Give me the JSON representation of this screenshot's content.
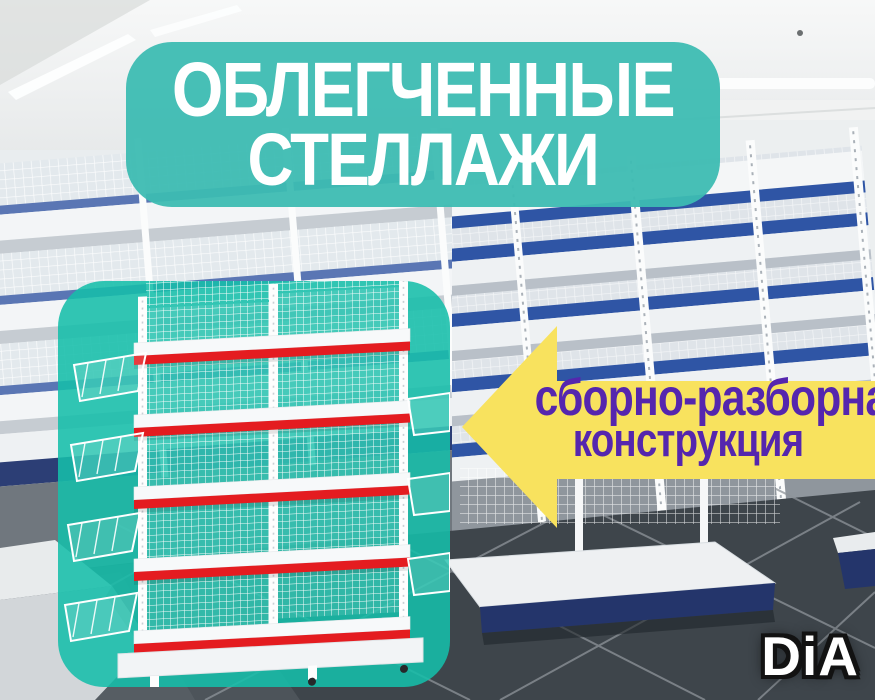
{
  "banner": {
    "line1": "ОБЛЕГЧЕННЫЕ",
    "line2": "СТЕЛЛАЖИ"
  },
  "callout": {
    "line1": "сборно-разборная",
    "line2": "конструкция"
  },
  "logo": {
    "text": "DiA"
  },
  "colors": {
    "banner_teal": "#3dbcb2",
    "card_teal": "#16beaa",
    "title_text": "#ffffff",
    "arrow_yellow": "#f8e25e",
    "callout_text": "#5526ae",
    "shelf_strip_red": "#e41c20",
    "shelving_blue": "#2f55a5",
    "floor_dark": "#3e454b",
    "logo_text": "#ffffff",
    "logo_outline": "#121212"
  }
}
